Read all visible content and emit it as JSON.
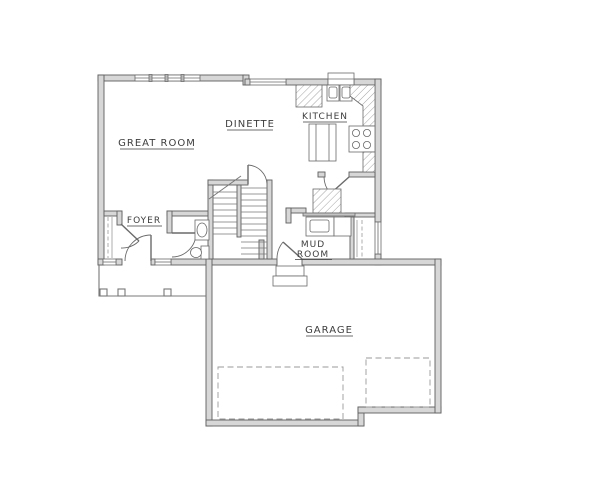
{
  "drawing": {
    "type": "residential-floor-plan",
    "floor": "main-level"
  },
  "colors": {
    "background": "#ffffff",
    "wall_fill": "#d7d7d7",
    "wall_line": "#5f5f5f",
    "thin_line": "#787878",
    "dashed_line": "#9a9a9a",
    "hatch_line": "#8d8d8d",
    "label_text": "#3d3d3d"
  },
  "rooms": {
    "great_room": {
      "label": "GREAT ROOM"
    },
    "dinette": {
      "label": "DINETTE"
    },
    "kitchen": {
      "label": "KITCHEN"
    },
    "foyer": {
      "label": "FOYER"
    },
    "mud_room": {
      "label_line1": "MUD",
      "label_line2": "ROOM"
    },
    "garage": {
      "label": "GARAGE"
    }
  }
}
